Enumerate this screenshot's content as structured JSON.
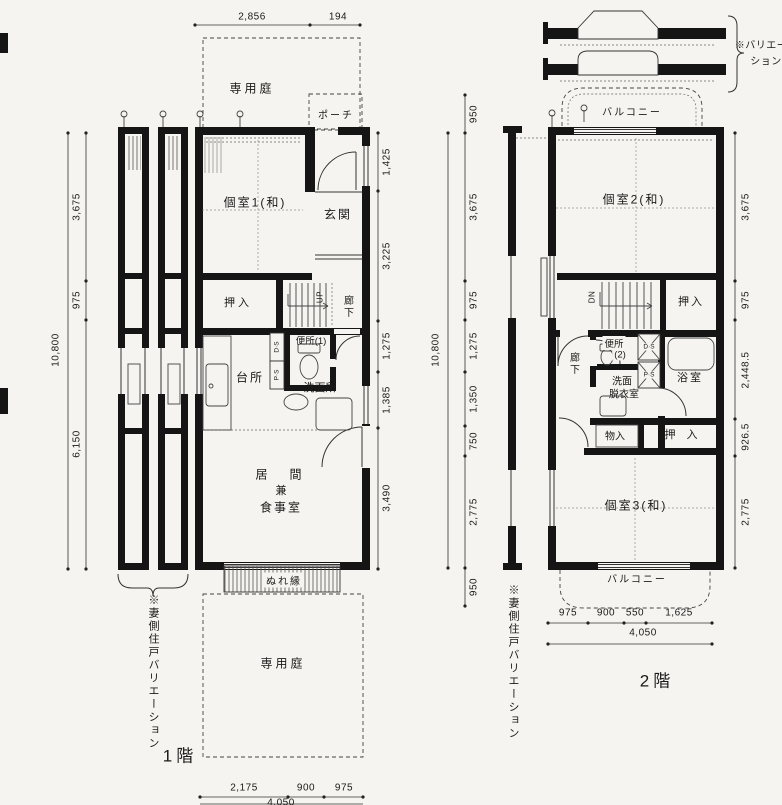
{
  "colors": {
    "paper": "#f5f4f0",
    "ink": "#1a1a1a"
  },
  "annotations": {
    "variation_note_line1": "※バリエー",
    "variation_note_line2": "ション",
    "side_note_1f": "※妻側住戸バリエーション",
    "side_note_2f": "※妻側住戸バリエーション"
  },
  "plan1": {
    "floor_label": "1階",
    "rooms": {
      "garden_top": "専用庭",
      "porch": "ポーチ",
      "room1": "個室1(和)",
      "entrance": "玄関",
      "oshiire": "押入",
      "up": "UP",
      "hallway": "廊下",
      "toilet": "便所(1)",
      "duct_ds": "D·S",
      "duct_ps": "P·S",
      "kitchen": "台所",
      "washroom": "洗面所",
      "living_line1": "居　間",
      "living_line2": "兼",
      "living_line3": "食事室",
      "engawa": "ぬれ縁",
      "garden_bottom": "専用庭"
    },
    "dims": {
      "top": [
        "2,856",
        "194"
      ],
      "right": [
        "1,425",
        "3,225",
        "1,275",
        "1,385",
        "3,490"
      ],
      "left": [
        "3,675",
        "975",
        "6,150"
      ],
      "left_total": "10,800",
      "bottom": [
        "2,175",
        "900",
        "975"
      ],
      "bottom_total": "4,050"
    }
  },
  "plan2": {
    "floor_label": "2階",
    "rooms": {
      "balcony_top": "バルコニー",
      "room2": "個室2(和)",
      "dn": "DN",
      "oshiire_top": "押入",
      "toilet_line1": "便所",
      "toilet_line2": "(2)",
      "duct_ds": "D·S",
      "duct_ps": "P·S",
      "bath": "浴室",
      "hallway": "廊下",
      "wash_line1": "洗面",
      "wash_line2": "脱衣室",
      "storage": "物入",
      "oshiire_bottom": "押　入",
      "room3": "個室3(和)",
      "balcony_bottom": "バルコニー"
    },
    "dims": {
      "left": [
        "950",
        "3,675",
        "975",
        "1,275",
        "1,350",
        "750",
        "2,775",
        "950"
      ],
      "left_total": "10,800",
      "right": [
        "3,675",
        "975",
        "2,448.5",
        "926.5",
        "2,775"
      ],
      "bottom": [
        "975",
        "900",
        "550",
        "1,625"
      ],
      "bottom_total": "4,050"
    }
  }
}
